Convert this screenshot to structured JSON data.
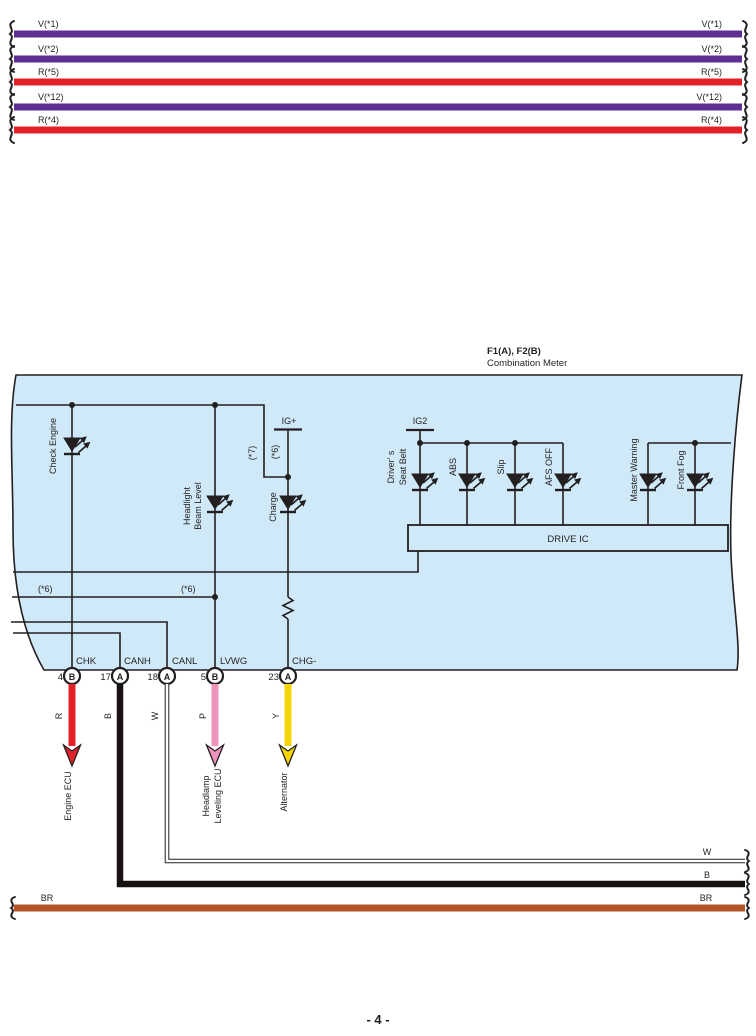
{
  "diagram": {
    "page_number": "- 4 -",
    "line_color": "#231f20",
    "meter_fill": "#cfe9f8"
  },
  "top_wires": [
    {
      "label": "V(*1)",
      "color": "#5e2f91"
    },
    {
      "label": "V(*2)",
      "color": "#5e2f91"
    },
    {
      "label": "R(*5)",
      "color": "#e32129"
    },
    {
      "label": "V(*12)",
      "color": "#5e2f91"
    },
    {
      "label": "R(*4)",
      "color": "#e32129"
    }
  ],
  "meter": {
    "connector_codes": "F1(A), F2(B)",
    "name": "Combination Meter",
    "drive_ic": "DRIVE IC",
    "ig_plus": "IG+",
    "ig2": "IG2",
    "note_7": "(*7)",
    "note_6": "(*6)",
    "indicators": {
      "check_engine": "Check Engine",
      "headlight_1": "Headlight",
      "headlight_2": "Beam Level",
      "charge": "Charge",
      "seat_belt_1": "Driver' s",
      "seat_belt_2": "Seat Belt",
      "abs": "ABS",
      "slip": "Slip",
      "afs_off": "AFS OFF",
      "master_warning": "Master Warning",
      "front_fog": "Front Fog"
    },
    "pins": [
      {
        "name": "CHK",
        "number": "4",
        "connector": "B"
      },
      {
        "name": "CANH",
        "number": "17",
        "connector": "A"
      },
      {
        "name": "CANL",
        "number": "18",
        "connector": "A"
      },
      {
        "name": "LVWG",
        "number": "5",
        "connector": "B"
      },
      {
        "name": "CHG-",
        "number": "23",
        "connector": "A"
      }
    ]
  },
  "wires": [
    {
      "code": "R",
      "color": "#e32129",
      "destination": "Engine ECU"
    },
    {
      "code": "B",
      "color": "#17120f",
      "right_label": "B"
    },
    {
      "code": "W",
      "color": "#ffffff",
      "right_label": "W"
    },
    {
      "code": "P",
      "color": "#f194bc",
      "destination_1": "Headlamp",
      "destination_2": "Leveling ECU"
    },
    {
      "code": "Y",
      "color": "#f4d500",
      "destination": "Alternator"
    }
  ],
  "ground_wire": {
    "label": "BR",
    "color": "#b65429"
  }
}
